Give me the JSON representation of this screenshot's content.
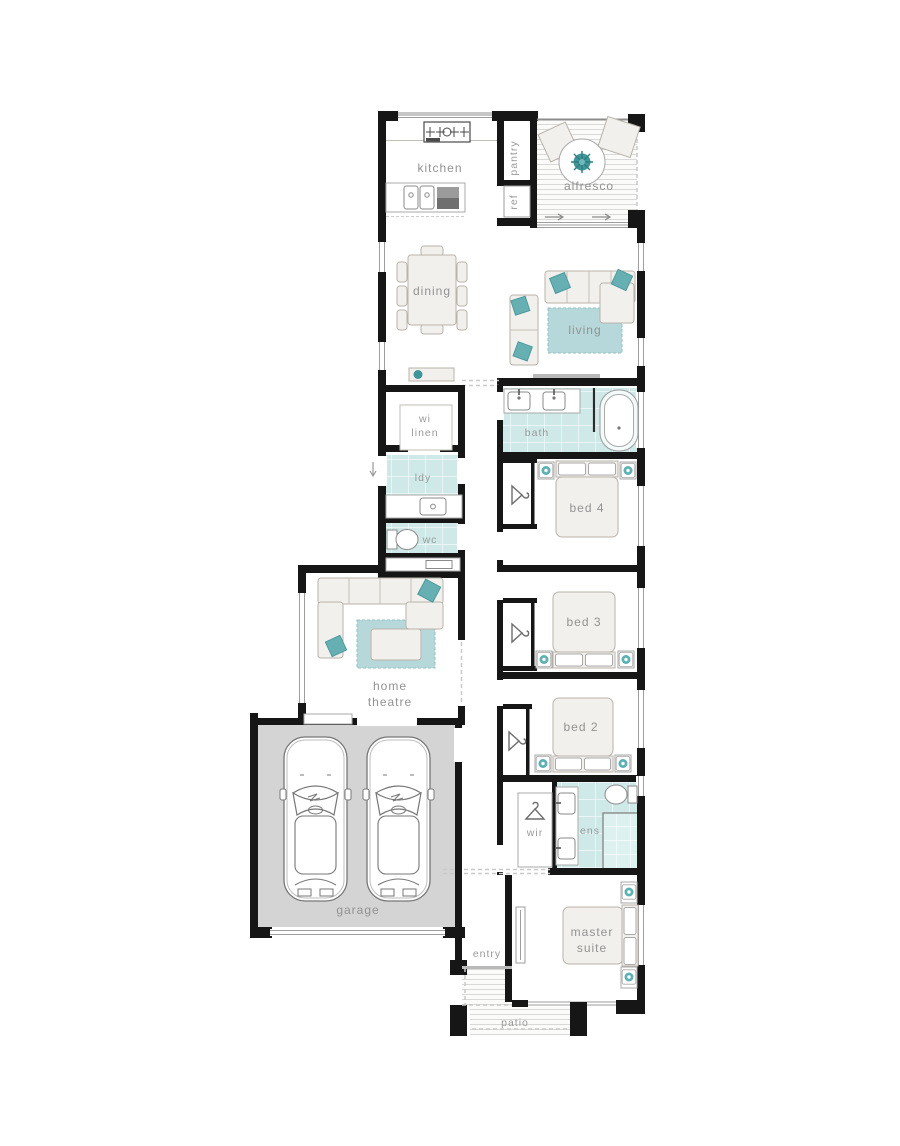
{
  "plan": {
    "type": "single-storey house floor plan",
    "colors": {
      "wall": "#161616",
      "tile_teal": "#cfe9e9",
      "rug_teal": "#b7d8da",
      "accent_teal": "#4fa3a8",
      "garage_floor": "#d4d4d4",
      "label_gray": "#929292"
    },
    "rooms": {
      "kitchen": {
        "label": "kitchen"
      },
      "pantry": {
        "label": "pantry"
      },
      "ref": {
        "label": "ref"
      },
      "alfresco": {
        "label": "alfresco"
      },
      "dining": {
        "label": "dining"
      },
      "living": {
        "label": "living"
      },
      "wi_linen": {
        "label_line1": "wi",
        "label_line2": "linen"
      },
      "bath": {
        "label": "bath"
      },
      "ldy": {
        "label": "ldy"
      },
      "bed4": {
        "label": "bed 4"
      },
      "wc": {
        "label": "wc"
      },
      "bed3": {
        "label": "bed 3"
      },
      "home_theatre": {
        "label_line1": "home",
        "label_line2": "theatre"
      },
      "bed2": {
        "label": "bed 2"
      },
      "wir": {
        "label": "wir"
      },
      "ens": {
        "label": "ens"
      },
      "garage": {
        "label": "garage"
      },
      "entry": {
        "label": "entry"
      },
      "master_suite": {
        "label_line1": "master",
        "label_line2": "suite"
      },
      "patio": {
        "label": "patio"
      }
    }
  }
}
